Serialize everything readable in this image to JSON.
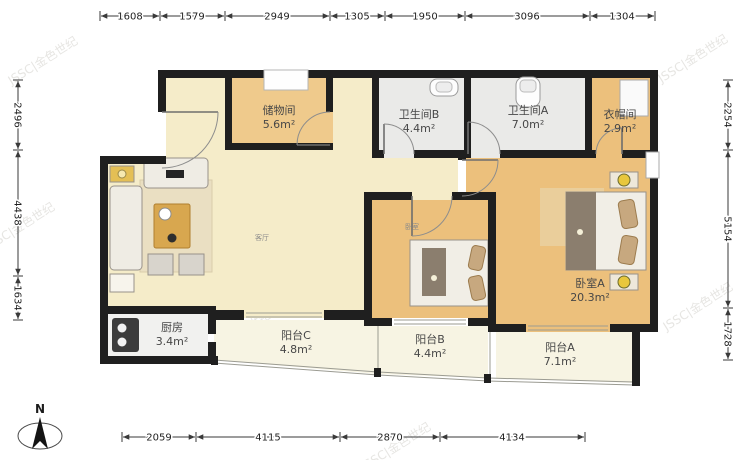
{
  "compass": {
    "label": "N"
  },
  "watermark": {
    "text": "JSSC|金色世纪"
  },
  "dimensions": {
    "top": [
      "1608",
      "1579",
      "2949",
      "1305",
      "1950",
      "3096",
      "1304"
    ],
    "bottom": [
      "2059",
      "4115",
      "2870",
      "4134"
    ],
    "left": [
      "2496",
      "4438",
      "1634"
    ],
    "right": [
      "2254",
      "5154",
      "1728"
    ]
  },
  "rooms": {
    "storage": {
      "name": "储物间",
      "area": "5.6m²"
    },
    "bathB": {
      "name": "卫生间B",
      "area": "4.4m²"
    },
    "bathA": {
      "name": "卫生间A",
      "area": "7.0m²"
    },
    "cloak": {
      "name": "衣帽间",
      "area": "2.9m²"
    },
    "living": {
      "name": "客厅",
      "area": ""
    },
    "bedroom": {
      "name": "卧室",
      "area": ""
    },
    "bedroomA": {
      "name": "卧室A",
      "area": "20.3m²"
    },
    "kitchen": {
      "name": "厨房",
      "area": "3.4m²"
    },
    "balconyC": {
      "name": "阳台C",
      "area": "4.8m²"
    },
    "balconyB": {
      "name": "阳台B",
      "area": "4.4m²"
    },
    "balconyA": {
      "name": "阳台A",
      "area": "7.1m²"
    }
  },
  "colors": {
    "wall": "#1f1f1f",
    "wood_floor": "#ecc07c",
    "storage_floor": "#efca8c",
    "living_floor": "#f5ecc9",
    "tile_floor": "#eaeae8",
    "balcony_floor": "#f7f4e3",
    "kitchen_floor": "#f1f1ef",
    "lamp_accent": "#e8c73c"
  }
}
